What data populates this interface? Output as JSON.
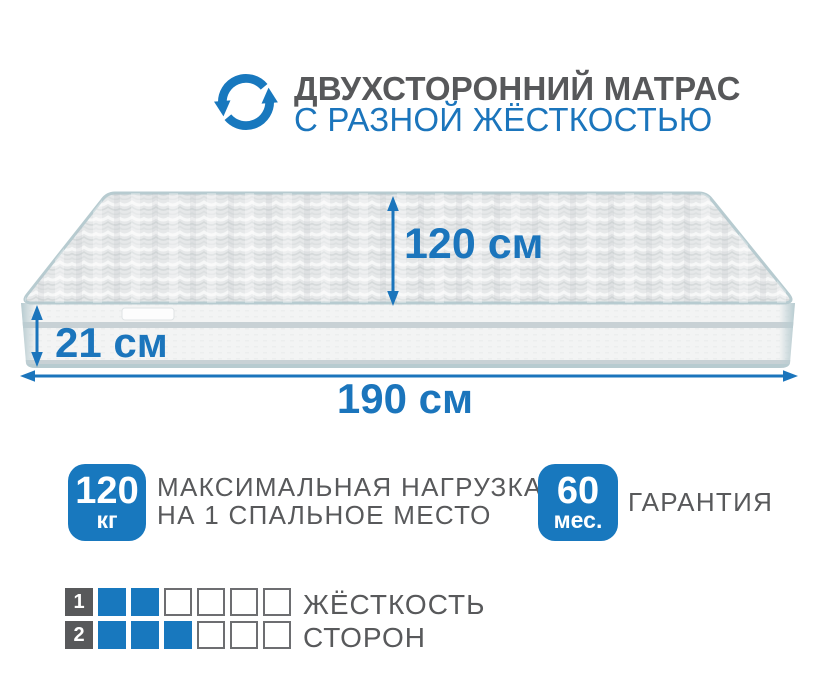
{
  "header": {
    "title": "ДВУХСТОРОННИЙ МАТРАС",
    "subtitle": "С РАЗНОЙ ЖЁСТКОСТЬЮ",
    "icon": "rotate-arrows-icon"
  },
  "mattress": {
    "depth_label": "120 см",
    "height_label": "21 см",
    "length_label": "190 см"
  },
  "features": [
    {
      "badge_value": "120",
      "badge_unit": "кг",
      "label_line1": "МАКСИМАЛЬНАЯ НАГРУЗКА",
      "label_line2": "НА 1 СПАЛЬНОЕ МЕСТО"
    },
    {
      "badge_value": "60",
      "badge_unit": "мес.",
      "label_line1": "ГАРАНТИЯ"
    }
  ],
  "firmness": {
    "label_line1": "ЖЁСТКОСТЬ",
    "label_line2": "СТОРОН",
    "scale_max": 6,
    "rows": [
      {
        "label": "1",
        "filled": 2
      },
      {
        "label": "2",
        "filled": 3
      }
    ]
  },
  "colors": {
    "accent_blue": "#1878be",
    "dimension_blue": "#1b75bc",
    "text_gray": "#58595b",
    "piping_teal": "#b7cbd0",
    "square_border_gray": "#6d6e71"
  }
}
